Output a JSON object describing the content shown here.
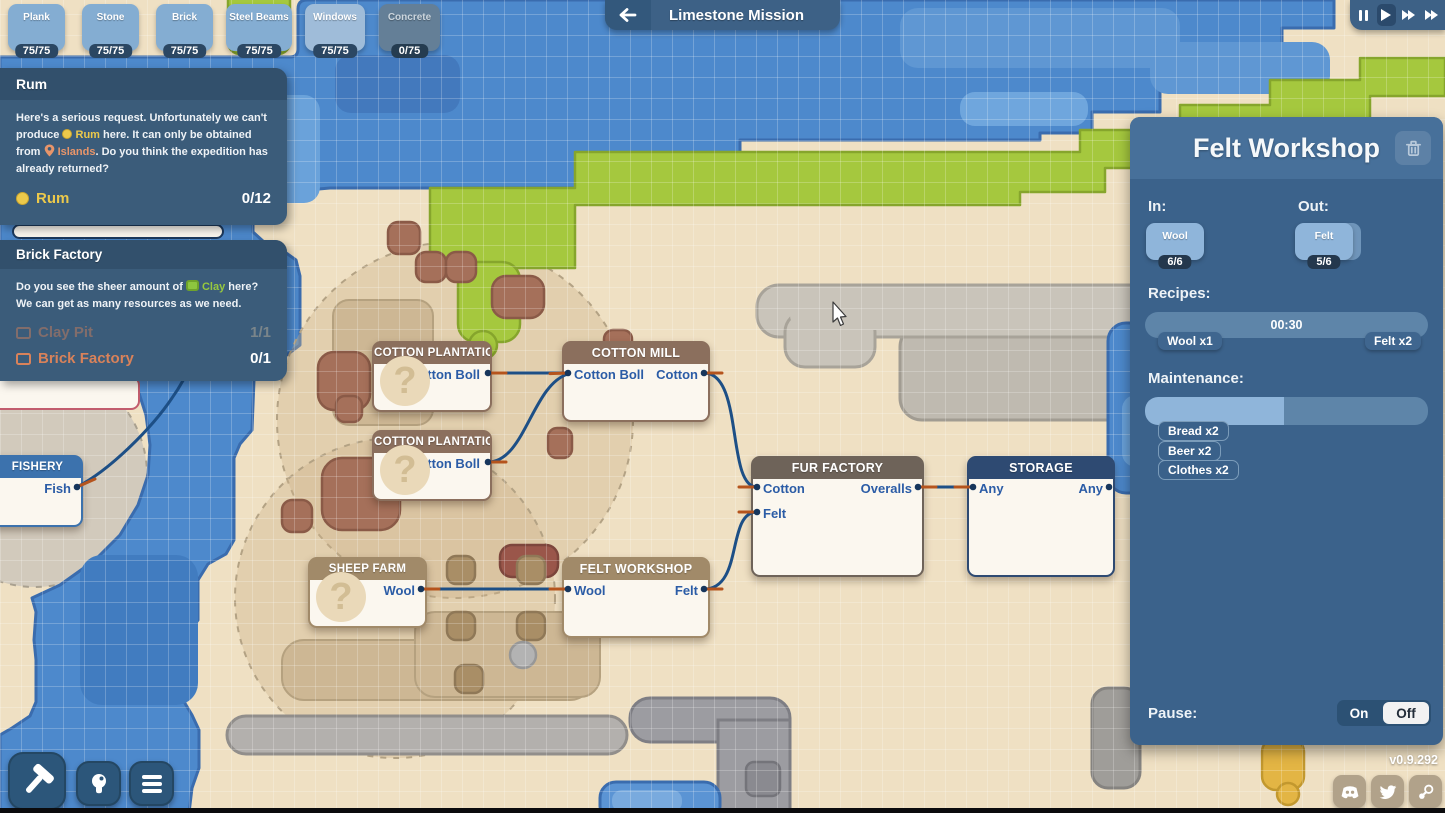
{
  "meta": {
    "version": "v0.9.292",
    "qmark": "?"
  },
  "colors": {
    "water": "#4d89cc",
    "land": "#efe0c3",
    "green": "#a5c83e",
    "panel_bg": "#3b628b",
    "accent_yellow": "#ecc94b",
    "accent_orange": "#e8956a",
    "accent_green": "#97c83e",
    "port_text": "#2b5ca6",
    "wire": "#1d4f86",
    "wire_tip": "#b5541d"
  },
  "icons": {
    "back": "arrow-left",
    "playback": [
      "pause",
      "play",
      "fast-forward",
      "skip"
    ],
    "trash": "trash",
    "social": [
      "discord",
      "twitter",
      "steam"
    ],
    "toolbar": [
      "hammer",
      "lightbulb",
      "menu"
    ]
  },
  "top_bar": {
    "mission_title": "Limestone Mission"
  },
  "resources": [
    {
      "name": "Plank",
      "count": "75/75"
    },
    {
      "name": "Stone",
      "count": "75/75"
    },
    {
      "name": "Brick",
      "count": "75/75"
    },
    {
      "name": "Steel Beams",
      "count": "75/75"
    },
    {
      "name": "Windows",
      "count": "75/75"
    },
    {
      "name": "Concrete",
      "count": "0/75"
    }
  ],
  "quests": {
    "rum": {
      "title": "Rum",
      "body1": "Here's a serious request. Unfortunately we can't produce ",
      "rum": "Rum",
      "body2": " here. It can only be obtained from ",
      "islands": "Islands",
      "body3": ". Do you think the expedition has already returned?",
      "goal_label": "Rum",
      "goal_count": "0/12"
    },
    "brick": {
      "title": "Brick Factory",
      "body1": "Do you see the sheer amount of ",
      "clay": "Clay",
      "body2": " here? We can get as many resources as we need.",
      "row1_label": "Clay Pit",
      "row1_count": "1/1",
      "row2_label": "Brick Factory",
      "row2_count": "0/1"
    }
  },
  "nodes": {
    "fishery": {
      "title": "FISHERY",
      "out": "Fish"
    },
    "p1": {
      "title": "COTTON PLANTATION",
      "out": "Cotton Boll"
    },
    "p2": {
      "title": "COTTON PLANTATION",
      "out": "Cotton Boll"
    },
    "mill": {
      "title": "COTTON MILL",
      "in": "Cotton Boll",
      "out": "Cotton"
    },
    "fur": {
      "title": "FUR FACTORY",
      "in1": "Cotton",
      "in2": "Felt",
      "out": "Overalls"
    },
    "storage": {
      "title": "STORAGE",
      "in": "Any",
      "out": "Any"
    },
    "sheep": {
      "title": "SHEEP FARM",
      "out": "Wool"
    },
    "felt": {
      "title": "FELT WORKSHOP",
      "in": "Wool",
      "out": "Felt"
    }
  },
  "panel": {
    "title": "Felt Workshop",
    "in_label": "In:",
    "out_label": "Out:",
    "in_name": "Wool",
    "in_count": "6/6",
    "out_name": "Felt",
    "out_count": "5/6",
    "recipes_label": "Recipes:",
    "recipe_time": "00:30",
    "recipe_in": "Wool x1",
    "recipe_out": "Felt x2",
    "maintenance_label": "Maintenance:",
    "maintenance_fill_pct": 49,
    "m1": "Bread x2",
    "m2": "Beer x2",
    "m3": "Clothes x2",
    "pause_label": "Pause:",
    "on": "On",
    "off": "Off"
  }
}
